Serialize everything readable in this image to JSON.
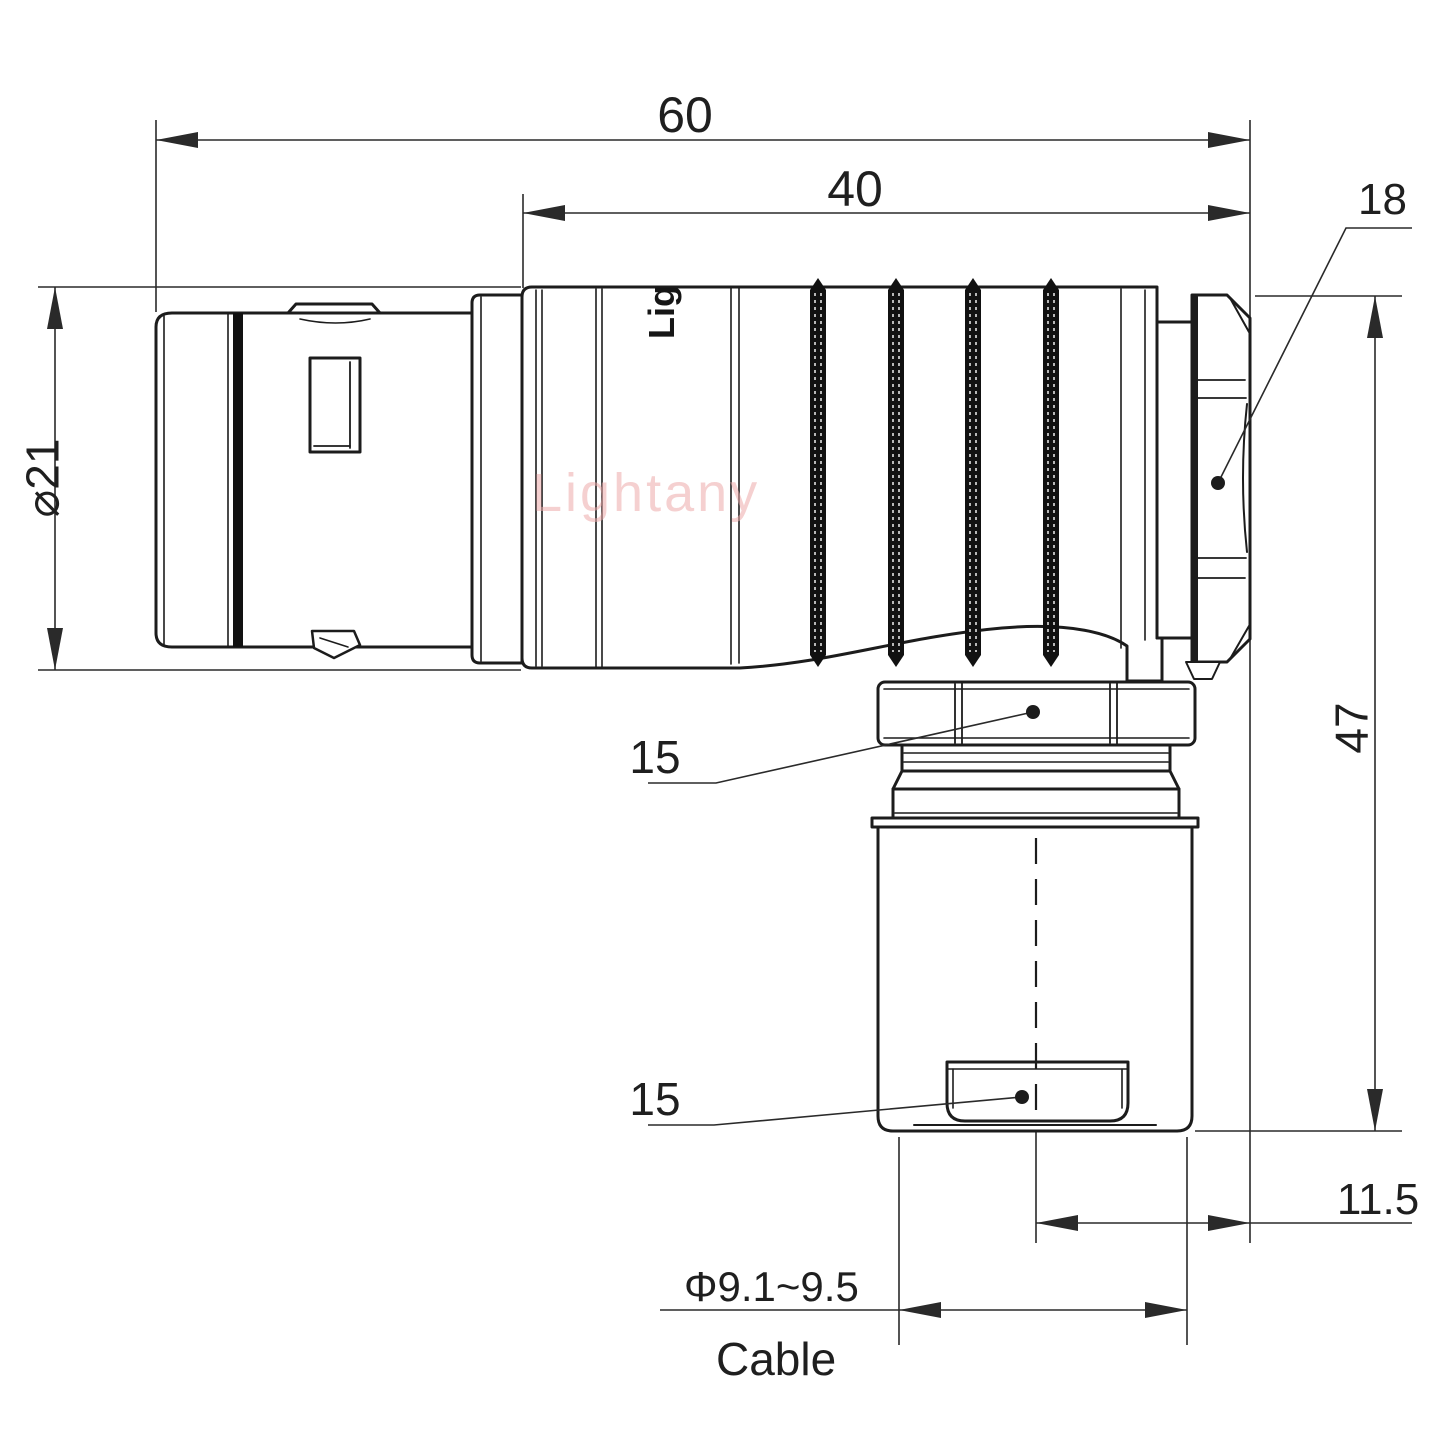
{
  "drawing": {
    "type": "technical-drawing",
    "subject": "right-angle push-pull circular connector, side elevation with dimensions",
    "background": "#ffffff",
    "line_color": "#1c1c1c",
    "dim_line_color": "#2a2a2a"
  },
  "labels": {
    "overall_length": "60",
    "housing_length": "40",
    "backnut": "18",
    "shell_dia": "⌀21",
    "height": "47",
    "nut_upper": "15",
    "nut_lower": "15",
    "center_offset": "11.5",
    "cable_dia": "Φ9.1~9.5",
    "cable": "Cable"
  },
  "watermark": {
    "text": "Lightany",
    "color": "rgba(236,170,170,0.55)"
  },
  "marking": "Lig"
}
